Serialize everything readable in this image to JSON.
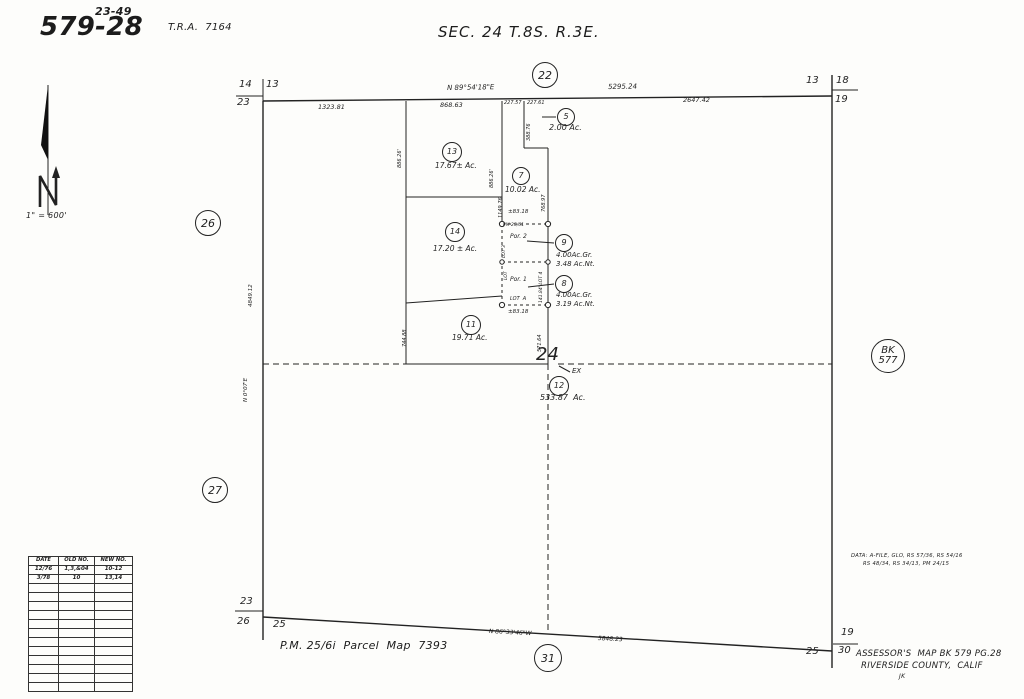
{
  "header": {
    "map_number_sup": "23-49",
    "map_number": "579-28",
    "tra": "T.R.A.  7164",
    "section_title": "SEC. 24 T.8S. R.3E.",
    "scale_note": "1\" = 600'"
  },
  "footer": {
    "parcel_map_ref": "P.M. 25/6i  Parcel  Map  7393",
    "data_note_line1": "DATA: A-FILE, GLO, RS 57/36, RS 54/16",
    "data_note_line2": "RS 48/34, RS 34/13, PM 24/15",
    "assessor_line1": "ASSESSOR'S  MAP BK 579 PG.28",
    "assessor_line2": "RIVERSIDE COUNTY,  CALIF",
    "initials": "JK"
  },
  "revision_table": {
    "headers": [
      "DATE",
      "OLD NO.",
      "NEW NO."
    ],
    "rows": [
      [
        "12/76",
        "1,3,&04",
        "10-12"
      ],
      [
        "3/78",
        "10",
        "13,14"
      ],
      [
        "",
        "",
        ""
      ],
      [
        "",
        "",
        ""
      ],
      [
        "",
        "",
        ""
      ],
      [
        "",
        "",
        ""
      ],
      [
        "",
        "",
        ""
      ],
      [
        "",
        "",
        ""
      ],
      [
        "",
        "",
        ""
      ],
      [
        "",
        "",
        ""
      ],
      [
        "",
        "",
        ""
      ],
      [
        "",
        "",
        ""
      ],
      [
        "",
        "",
        ""
      ],
      [
        "",
        "",
        ""
      ]
    ]
  },
  "circles": [
    {
      "name": "section-corner-22",
      "label": "22",
      "x": 545,
      "y": 75,
      "r": 13,
      "size": 11
    },
    {
      "name": "parcel-5",
      "label": "5",
      "x": 566,
      "y": 117,
      "r": 9,
      "size": 8
    },
    {
      "name": "parcel-13",
      "label": "13",
      "x": 452,
      "y": 152,
      "r": 10,
      "size": 8
    },
    {
      "name": "parcel-7",
      "label": "7",
      "x": 521,
      "y": 176,
      "r": 9,
      "size": 8
    },
    {
      "name": "parcel-14",
      "label": "14",
      "x": 455,
      "y": 232,
      "r": 10,
      "size": 8
    },
    {
      "name": "parcel-9",
      "label": "9",
      "x": 564,
      "y": 243,
      "r": 9,
      "size": 8
    },
    {
      "name": "parcel-8",
      "label": "8",
      "x": 564,
      "y": 284,
      "r": 9,
      "size": 8
    },
    {
      "name": "parcel-11",
      "label": "11",
      "x": 471,
      "y": 325,
      "r": 10,
      "size": 8
    },
    {
      "name": "parcel-12",
      "label": "12",
      "x": 559,
      "y": 386,
      "r": 10,
      "size": 8
    },
    {
      "name": "section-26",
      "label": "26",
      "x": 208,
      "y": 223,
      "r": 13,
      "size": 11
    },
    {
      "name": "section-27",
      "label": "27",
      "x": 215,
      "y": 490,
      "r": 13,
      "size": 11
    },
    {
      "name": "section-31",
      "label": "31",
      "x": 548,
      "y": 658,
      "r": 14,
      "size": 11
    },
    {
      "name": "book-577",
      "label": "BK\n577",
      "x": 888,
      "y": 356,
      "r": 17,
      "size": 10
    }
  ],
  "labels": [
    {
      "name": "bearing-north-line",
      "text": "N 89°54'18\"E",
      "x": 447,
      "y": 85,
      "size": 7,
      "rot": -1
    },
    {
      "name": "dim-5295-24",
      "text": "5295.24",
      "x": 608,
      "y": 84,
      "size": 7,
      "rot": -1
    },
    {
      "name": "dim-2647-42",
      "text": "2647.42",
      "x": 683,
      "y": 97,
      "size": 6.5,
      "rot": 0
    },
    {
      "name": "dim-1323-81",
      "text": "1323.81",
      "x": 318,
      "y": 104,
      "size": 6.5,
      "rot": 0
    },
    {
      "name": "dim-868-63",
      "text": "868.63",
      "x": 440,
      "y": 102,
      "size": 6.5,
      "rot": 0
    },
    {
      "name": "dim-227-57",
      "text": "227.57",
      "x": 504,
      "y": 101,
      "size": 5,
      "rot": 0
    },
    {
      "name": "dim-227-61",
      "text": "227.61",
      "x": 527,
      "y": 101,
      "size": 5,
      "rot": 0
    },
    {
      "name": "dim-388-76",
      "text": "388.76",
      "x": 527,
      "y": 141,
      "size": 5,
      "rot": -90
    },
    {
      "name": "parcel-5-acreage",
      "text": "2.00 Ac.",
      "x": 549,
      "y": 124,
      "size": 8,
      "rot": 0
    },
    {
      "name": "parcel-13-acreage",
      "text": "17.67± Ac.",
      "x": 435,
      "y": 162,
      "size": 7.5,
      "rot": 0
    },
    {
      "name": "parcel-7-acreage",
      "text": "10.02 Ac.",
      "x": 505,
      "y": 186,
      "size": 7.5,
      "rot": 0
    },
    {
      "name": "parcel-14-acreage",
      "text": "17.20 ± Ac.",
      "x": 433,
      "y": 245,
      "size": 7.5,
      "rot": 0
    },
    {
      "name": "parcel-9-acreage-gross",
      "text": "4.00Ac.Gr.",
      "x": 556,
      "y": 252,
      "size": 7,
      "rot": 0
    },
    {
      "name": "parcel-9-acreage-net",
      "text": "3.48 Ac.Nt.",
      "x": 556,
      "y": 261,
      "size": 7,
      "rot": 0
    },
    {
      "name": "parcel-8-acreage-gross",
      "text": "4.00Ac.Gr.",
      "x": 556,
      "y": 292,
      "size": 7,
      "rot": 0
    },
    {
      "name": "parcel-8-acreage-net",
      "text": "3.19 Ac.Nt.",
      "x": 556,
      "y": 301,
      "size": 7,
      "rot": 0
    },
    {
      "name": "parcel-11-acreage",
      "text": "19.71 Ac.",
      "x": 452,
      "y": 334,
      "size": 7.5,
      "rot": 0
    },
    {
      "name": "parcel-12-ex",
      "text": "EX",
      "x": 572,
      "y": 368,
      "size": 7,
      "rot": 0
    },
    {
      "name": "parcel-12-acreage",
      "text": "533.87  Ac.",
      "x": 540,
      "y": 394,
      "size": 8,
      "rot": 0
    },
    {
      "name": "dim-886-26-west",
      "text": "886.26'",
      "x": 398,
      "y": 168,
      "size": 5,
      "rot": -90
    },
    {
      "name": "dim-886-26-east",
      "text": "886.26'",
      "x": 490,
      "y": 188,
      "size": 5,
      "rot": -90
    },
    {
      "name": "dim-1149-76",
      "text": "1149.76",
      "x": 499,
      "y": 218,
      "size": 5,
      "rot": -90
    },
    {
      "name": "dim-768-97",
      "text": "768.97",
      "x": 542,
      "y": 212,
      "size": 5,
      "rot": -90
    },
    {
      "name": "dim-83-18-top",
      "text": "±83.18",
      "x": 508,
      "y": 210,
      "size": 5.5,
      "rot": 0
    },
    {
      "name": "pm-25-61-inner",
      "text": "PM 25/61",
      "x": 503,
      "y": 224,
      "size": 4.5,
      "rot": 0
    },
    {
      "name": "por-2-label",
      "text": "Por. 2",
      "x": 510,
      "y": 234,
      "size": 6,
      "rot": 0
    },
    {
      "name": "lot-3-label",
      "text": "LOT 3",
      "x": 503,
      "y": 258,
      "size": 4.5,
      "rot": -90
    },
    {
      "name": "lot-label",
      "text": "LOT",
      "x": 505,
      "y": 280,
      "size": 4.5,
      "rot": -90
    },
    {
      "name": "dim-141-84-lot-4",
      "text": "141.84' LOT 4",
      "x": 540,
      "y": 303,
      "size": 4.5,
      "rot": -90
    },
    {
      "name": "por-1-label",
      "text": "Por. 1",
      "x": 510,
      "y": 277,
      "size": 6,
      "rot": 0
    },
    {
      "name": "lot-a-label",
      "text": "LOT  A",
      "x": 510,
      "y": 297,
      "size": 5,
      "rot": 0
    },
    {
      "name": "dim-83-18-bottom",
      "text": "±83.18",
      "x": 508,
      "y": 310,
      "size": 5.5,
      "rot": 0
    },
    {
      "name": "dim-571-64",
      "text": "571.64",
      "x": 538,
      "y": 352,
      "size": 5,
      "rot": -90
    },
    {
      "name": "dim-744-88",
      "text": "744.88",
      "x": 403,
      "y": 347,
      "size": 5,
      "rot": -90
    },
    {
      "name": "dim-4849-12",
      "text": "4849.12",
      "x": 249,
      "y": 307,
      "size": 5.5,
      "rot": -90
    },
    {
      "name": "bearing-west-line",
      "text": "N 0°07'E",
      "x": 244,
      "y": 402,
      "size": 5.5,
      "rot": -90
    },
    {
      "name": "quarter-corner-24",
      "text": "24",
      "x": 536,
      "y": 346,
      "size": 18,
      "rot": 0
    },
    {
      "name": "bearing-south-line",
      "text": "N 86°33'46\"W",
      "x": 489,
      "y": 629,
      "size": 6,
      "rot": 3
    },
    {
      "name": "dim-5848-23",
      "text": "5848.23",
      "x": 598,
      "y": 636,
      "size": 6,
      "rot": 3
    },
    {
      "name": "corner-tl-14",
      "text": "14",
      "x": 239,
      "y": 80,
      "size": 10,
      "rot": 0
    },
    {
      "name": "corner-tl-13",
      "text": "13",
      "x": 266,
      "y": 80,
      "size": 10,
      "rot": 0
    },
    {
      "name": "corner-tl-23",
      "text": "23",
      "x": 237,
      "y": 98,
      "size": 10,
      "rot": 0
    },
    {
      "name": "corner-tr-13",
      "text": "13",
      "x": 806,
      "y": 76,
      "size": 10,
      "rot": 0
    },
    {
      "name": "corner-tr-18",
      "text": "18",
      "x": 836,
      "y": 76,
      "size": 10,
      "rot": 0
    },
    {
      "name": "corner-tr-19",
      "text": "19",
      "x": 835,
      "y": 95,
      "size": 10,
      "rot": 0
    },
    {
      "name": "corner-bl-23",
      "text": "23",
      "x": 240,
      "y": 597,
      "size": 10,
      "rot": 0
    },
    {
      "name": "corner-bl-26",
      "text": "26",
      "x": 237,
      "y": 617,
      "size": 10,
      "rot": 0
    },
    {
      "name": "corner-bl-25",
      "text": "25",
      "x": 273,
      "y": 620,
      "size": 10,
      "rot": 0
    },
    {
      "name": "corner-br-19",
      "text": "19",
      "x": 841,
      "y": 628,
      "size": 10,
      "rot": 0
    },
    {
      "name": "corner-br-30",
      "text": "30",
      "x": 838,
      "y": 646,
      "size": 10,
      "rot": 0
    },
    {
      "name": "corner-br-25",
      "text": "25",
      "x": 806,
      "y": 647,
      "size": 10,
      "rot": 0
    }
  ]
}
